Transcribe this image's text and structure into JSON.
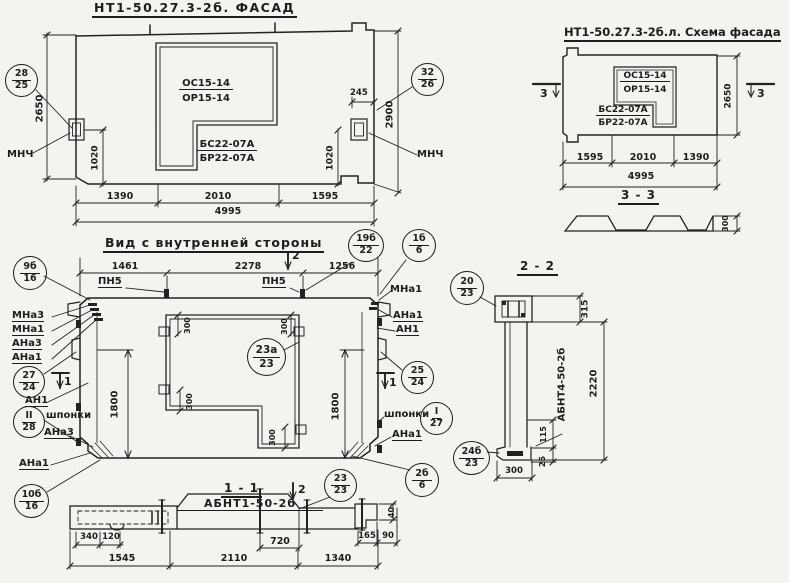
{
  "facade": {
    "title": "НТ1-50.27.3-2б. ФАСАД",
    "window_mark_top": "ОС15-14",
    "window_mark_bottom": "ОР15-14",
    "sill_mark_top": "БС22-07А",
    "sill_mark_bottom": "БР22-07А",
    "balloon_left_top": "28",
    "balloon_left_bottom": "25",
    "balloon_right_top": "32",
    "balloon_right_bottom": "26",
    "anchor_label_left": "МНЧ",
    "anchor_label_right": "МНЧ",
    "dim_height_left": "2650",
    "dim_height_right": "2900",
    "dim_anchor_left": "1020",
    "dim_anchor_right": "1020",
    "dim_window_offset": "245",
    "dim_b1": "1390",
    "dim_b2": "2010",
    "dim_b3": "1595",
    "dim_total": "4995"
  },
  "schema": {
    "title": "НТ1-50.27.3-2б.л. Схема фасада",
    "window_mark_top": "ОС15-14",
    "window_mark_bottom": "ОР15-14",
    "sill_mark_top": "БС22-07А",
    "sill_mark_bottom": "БР22-07А",
    "section_mark_left": "3",
    "section_mark_right": "3",
    "dim_height": "2650",
    "dim_b1": "1595",
    "dim_b2": "2010",
    "dim_b3": "1390",
    "dim_total": "4995"
  },
  "section33": {
    "title": "3 - 3",
    "dim_thickness": "300"
  },
  "interior": {
    "title": "Вид с внутренней стороны",
    "dim_t1": "1461",
    "dim_t2": "2278",
    "dim_t3": "1256",
    "pn5_left": "ПН5",
    "pn5_right": "ПН5",
    "cut2_top": "2",
    "cut2_bottom": "2",
    "cut1_left": "1",
    "cut1_right": "1",
    "balloon_19b_top": "19б",
    "balloon_19b_bottom": "22",
    "balloon_1b_top": "1б",
    "balloon_1b_bottom": "6",
    "balloon_9b_top": "9б",
    "balloon_9b_bottom": "16",
    "mna1_top_right": "МНа1",
    "left_labels": [
      "МНа3",
      "МНа1",
      "АНа3",
      "АНа1"
    ],
    "balloon_27_top": "27",
    "balloon_27_bottom": "24",
    "an1_left": "АН1",
    "balloon_sh_left_top": "II",
    "balloon_sh_left_bottom": "28",
    "shponki_left": "шпонки",
    "ana3_left_mid": "АНа3",
    "ana1_left_bottom": "АНа1",
    "balloon_10b_top": "10б",
    "balloon_10b_bottom": "16",
    "dim_1800_left": "1800",
    "dim_1800_right": "1800",
    "dim_300_1": "300",
    "dim_300_2": "300",
    "dim_300_3": "300",
    "dim_300_4": "300",
    "balloon_23a_top": "23а",
    "balloon_23a_bottom": "23",
    "ana1_right_1": "АНа1",
    "an1_right": "АН1",
    "balloon_25_top": "25",
    "balloon_25_bottom": "24",
    "shponki_right": "шпонки",
    "balloon_sh_right_top": "I",
    "balloon_sh_right_bottom": "27",
    "ana1_right_2": "АНа1",
    "balloon_2b_top": "2б",
    "balloon_2b_bottom": "6",
    "balloon_23_top": "23",
    "balloon_23_bottom": "23"
  },
  "section11": {
    "title": "1 - 1",
    "label": "АБНТ1-50-2б",
    "dim_340": "340",
    "dim_120": "120",
    "dim_720": "720",
    "dim_165": "165",
    "dim_90": "90",
    "dim_40": "40",
    "dim_b1": "1545",
    "dim_b2": "2110",
    "dim_b3": "1340"
  },
  "section22": {
    "title": "2 - 2",
    "balloon_20_top": "20",
    "balloon_20_bottom": "23",
    "balloon_24b_top": "24б",
    "balloon_24b_bottom": "23",
    "label": "АБНТ4-50-2б",
    "dim_315": "315",
    "dim_2220": "2220",
    "dim_115": "115",
    "dim_25": "25",
    "dim_300": "300"
  }
}
